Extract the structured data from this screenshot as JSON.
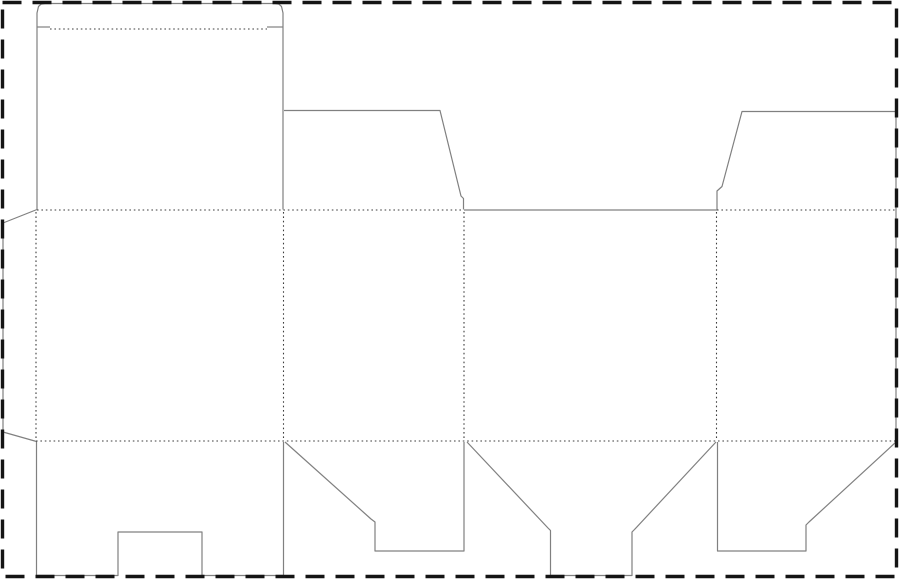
{
  "canvas": {
    "width": 900,
    "height": 580,
    "background": "#ffffff"
  },
  "styles": {
    "cut_line": {
      "color": "#808080",
      "width": 1.2
    },
    "fold_line": {
      "color": "#3d3d3d",
      "width": 1.1,
      "dash": "1.6 2.8"
    },
    "page_border": {
      "color": "#141414",
      "width": 3.4,
      "dash": "19 11"
    }
  },
  "page_border": {
    "x": 2.5,
    "y": 2.5,
    "width": 894,
    "height": 574
  },
  "dieline": {
    "description": "folding-carton-dieline-template",
    "cut_lines": [
      {
        "name": "panel1-top-cover-and-tuck-outline",
        "points": [
          [
            37,
            209.5
          ],
          [
            37,
            13
          ],
          [
            38.5,
            6.5
          ],
          [
            41,
            4.2
          ],
          [
            45,
            3.5
          ],
          [
            275,
            3.5
          ],
          [
            279,
            4.2
          ],
          [
            281.5,
            6.5
          ],
          [
            283,
            13
          ],
          [
            283,
            209.5
          ]
        ]
      },
      {
        "name": "tuck-shoulder-cut-left",
        "points": [
          [
            37,
            27
          ],
          [
            50,
            27
          ]
        ]
      },
      {
        "name": "tuck-shoulder-cut-right",
        "points": [
          [
            267,
            27
          ],
          [
            283,
            27
          ]
        ]
      },
      {
        "name": "panel2-top-dust-flap",
        "points": [
          [
            284,
            110.5
          ],
          [
            440,
            110.5
          ],
          [
            461,
            196
          ],
          [
            463.5,
            198.5
          ],
          [
            463.5,
            209.5
          ]
        ]
      },
      {
        "name": "panel3-top-edge-cut",
        "points": [
          [
            464,
            210
          ],
          [
            717,
            210
          ]
        ]
      },
      {
        "name": "panel4-top-dust-flap-and-right-edge",
        "points": [
          [
            717,
            209.5
          ],
          [
            717,
            191
          ],
          [
            722,
            186.5
          ],
          [
            742,
            111.5
          ],
          [
            896,
            111.5
          ],
          [
            896,
            441
          ]
        ]
      },
      {
        "name": "glue-flap-outline",
        "points": [
          [
            37,
            209.5
          ],
          [
            3,
            223
          ],
          [
            3,
            432
          ],
          [
            36.5,
            441.5
          ]
        ]
      },
      {
        "name": "panel1-bottom-flap-outline",
        "points": [
          [
            36.5,
            441.5
          ],
          [
            36.5,
            575.5
          ],
          [
            118,
            575.5
          ],
          [
            118,
            532
          ],
          [
            202,
            532
          ],
          [
            202,
            575.5
          ],
          [
            283.5,
            575.5
          ],
          [
            283.5,
            442
          ]
        ]
      },
      {
        "name": "panel2-bottom-flap-outline",
        "points": [
          [
            285,
            442
          ],
          [
            371,
            519
          ],
          [
            375,
            522
          ],
          [
            375,
            551
          ],
          [
            464,
            551
          ],
          [
            464,
            442
          ]
        ]
      },
      {
        "name": "panel3-bottom-lock-flap-outline",
        "points": [
          [
            467,
            442
          ],
          [
            548,
            528
          ],
          [
            550.5,
            530.5
          ],
          [
            550.5,
            575.5
          ],
          [
            632,
            575.5
          ],
          [
            632,
            532
          ],
          [
            634.5,
            529.5
          ],
          [
            716,
            442
          ]
        ]
      },
      {
        "name": "panel4-bottom-flap-outline",
        "points": [
          [
            717.5,
            442
          ],
          [
            717.5,
            551
          ],
          [
            806,
            551
          ],
          [
            806,
            525
          ],
          [
            809,
            522
          ],
          [
            896,
            442
          ]
        ]
      }
    ],
    "fold_lines": [
      {
        "name": "tuck-flap-fold",
        "points": [
          [
            50,
            29
          ],
          [
            267,
            29
          ]
        ]
      },
      {
        "name": "top-fold-panels-1-2",
        "points": [
          [
            37,
            210
          ],
          [
            463,
            210
          ]
        ]
      },
      {
        "name": "top-fold-panel-4",
        "points": [
          [
            717,
            210
          ],
          [
            896,
            210
          ]
        ]
      },
      {
        "name": "bottom-fold-full-width",
        "points": [
          [
            36,
            441
          ],
          [
            896,
            441
          ]
        ]
      },
      {
        "name": "glue-flap-fold",
        "points": [
          [
            36,
            212
          ],
          [
            36,
            440
          ]
        ]
      },
      {
        "name": "fold-panel1-panel2",
        "points": [
          [
            283.5,
            212
          ],
          [
            283.5,
            440
          ]
        ]
      },
      {
        "name": "fold-panel2-panel3",
        "points": [
          [
            464,
            212
          ],
          [
            464,
            440
          ]
        ]
      },
      {
        "name": "fold-panel3-panel4",
        "points": [
          [
            716.5,
            212
          ],
          [
            716.5,
            440
          ]
        ]
      }
    ]
  }
}
